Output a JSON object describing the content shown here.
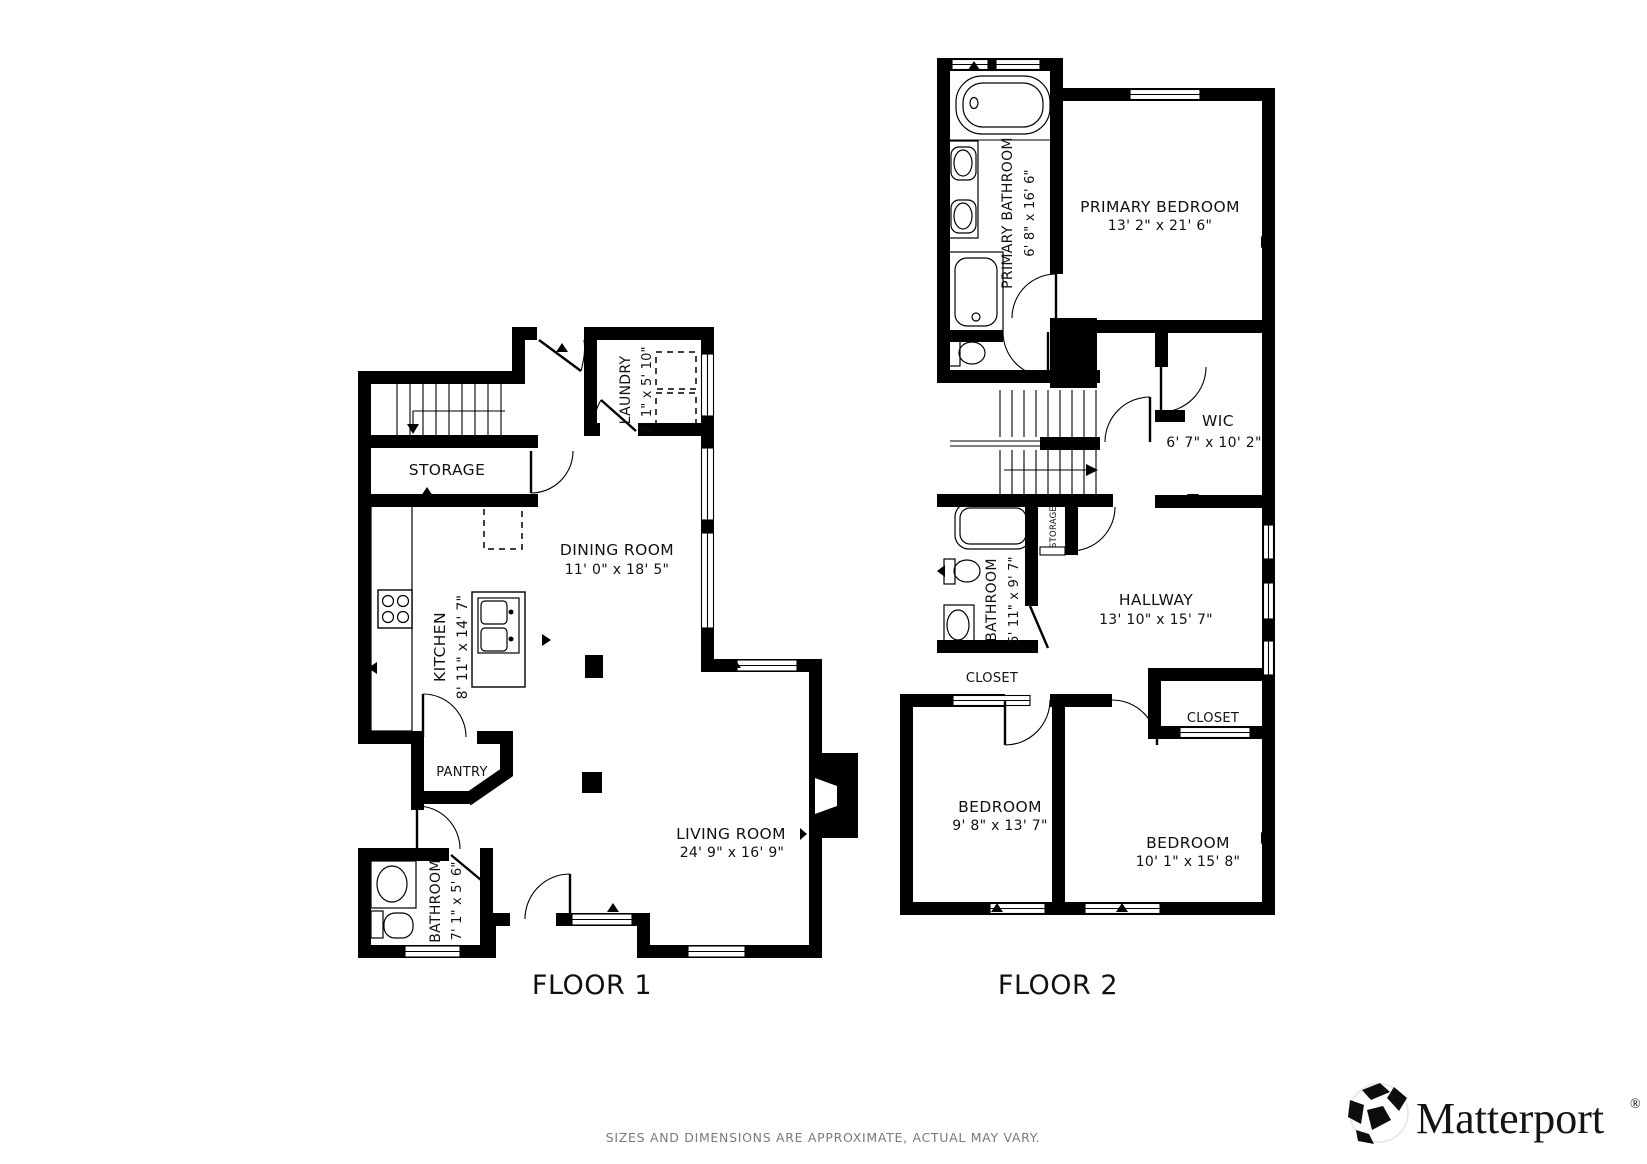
{
  "floor1": {
    "label": "FLOOR 1",
    "rooms": {
      "storage": {
        "name": "STORAGE"
      },
      "laundry": {
        "name": "LAUNDRY",
        "dims": "7' 1\" x 5' 10\""
      },
      "dining": {
        "name": "DINING ROOM",
        "dims": "11' 0\" x 18' 5\""
      },
      "kitchen": {
        "name": "KITCHEN",
        "dims": "8' 11\" x 14' 7\""
      },
      "pantry": {
        "name": "PANTRY"
      },
      "bathroom": {
        "name": "BATHROOM",
        "dims": "7' 1\" x 5' 6\""
      },
      "living": {
        "name": "LIVING ROOM",
        "dims": "24' 9\" x 16' 9\""
      }
    }
  },
  "floor2": {
    "label": "FLOOR 2",
    "rooms": {
      "primary_bathroom": {
        "name": "PRIMARY BATHROOM",
        "dims": "6' 8\" x 16' 6\""
      },
      "primary_bedroom": {
        "name": "PRIMARY BEDROOM",
        "dims": "13' 2\" x 21' 6\""
      },
      "wic": {
        "name": "WIC",
        "dims": "6' 7\" x 10' 2\""
      },
      "hallway": {
        "name": "HALLWAY",
        "dims": "13' 10\" x 15' 7\""
      },
      "bathroom": {
        "name": "BATHROOM",
        "dims": "5' 11\" x 9' 7\""
      },
      "storage": {
        "name": "STORAGE"
      },
      "closet_left": {
        "name": "CLOSET"
      },
      "closet_right": {
        "name": "CLOSET"
      },
      "bedroom_left": {
        "name": "BEDROOM",
        "dims": "9' 8\" x 13' 7\""
      },
      "bedroom_right": {
        "name": "BEDROOM",
        "dims": "10' 1\" x 15' 8\""
      }
    }
  },
  "footer": {
    "disclaimer": "SIZES AND DIMENSIONS ARE APPROXIMATE, ACTUAL MAY VARY."
  },
  "brand": {
    "name": "Matterport",
    "registered": "®"
  },
  "colors": {
    "wall": "#000000",
    "background": "#ffffff",
    "disclaimer_gray": "#7a7a7a"
  }
}
